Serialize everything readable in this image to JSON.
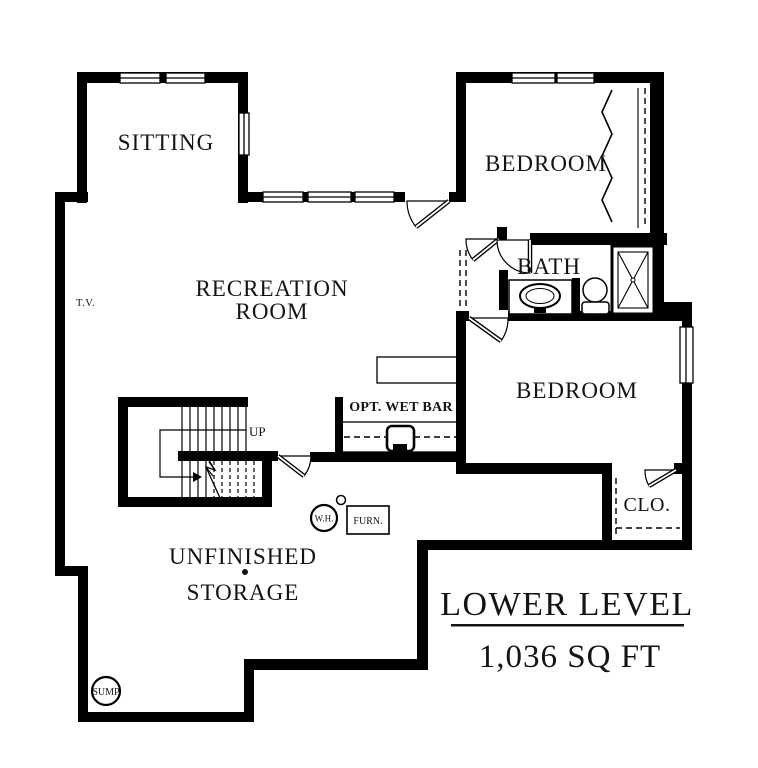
{
  "plan": {
    "rooms": {
      "sitting": "SITTING",
      "recreation_line1": "RECREATION",
      "recreation_line2": "ROOM",
      "bedroom_upper": "BEDROOM",
      "bath": "BATH",
      "bedroom_lower": "BEDROOM",
      "closet": "CLO.",
      "storage_line1": "UNFINISHED",
      "storage_line2": "STORAGE"
    },
    "annotations": {
      "up": "UP",
      "tv": "T.V.",
      "water_heater": "W.H.",
      "furnace": "FURN.",
      "sump": "SUMP",
      "wet_bar": "OPT. WET BAR"
    },
    "title_block": {
      "title": "LOWER LEVEL",
      "area": "1,036 SQ FT"
    },
    "colors": {
      "wall": "#000000",
      "background": "#ffffff",
      "text": "#141414"
    }
  }
}
